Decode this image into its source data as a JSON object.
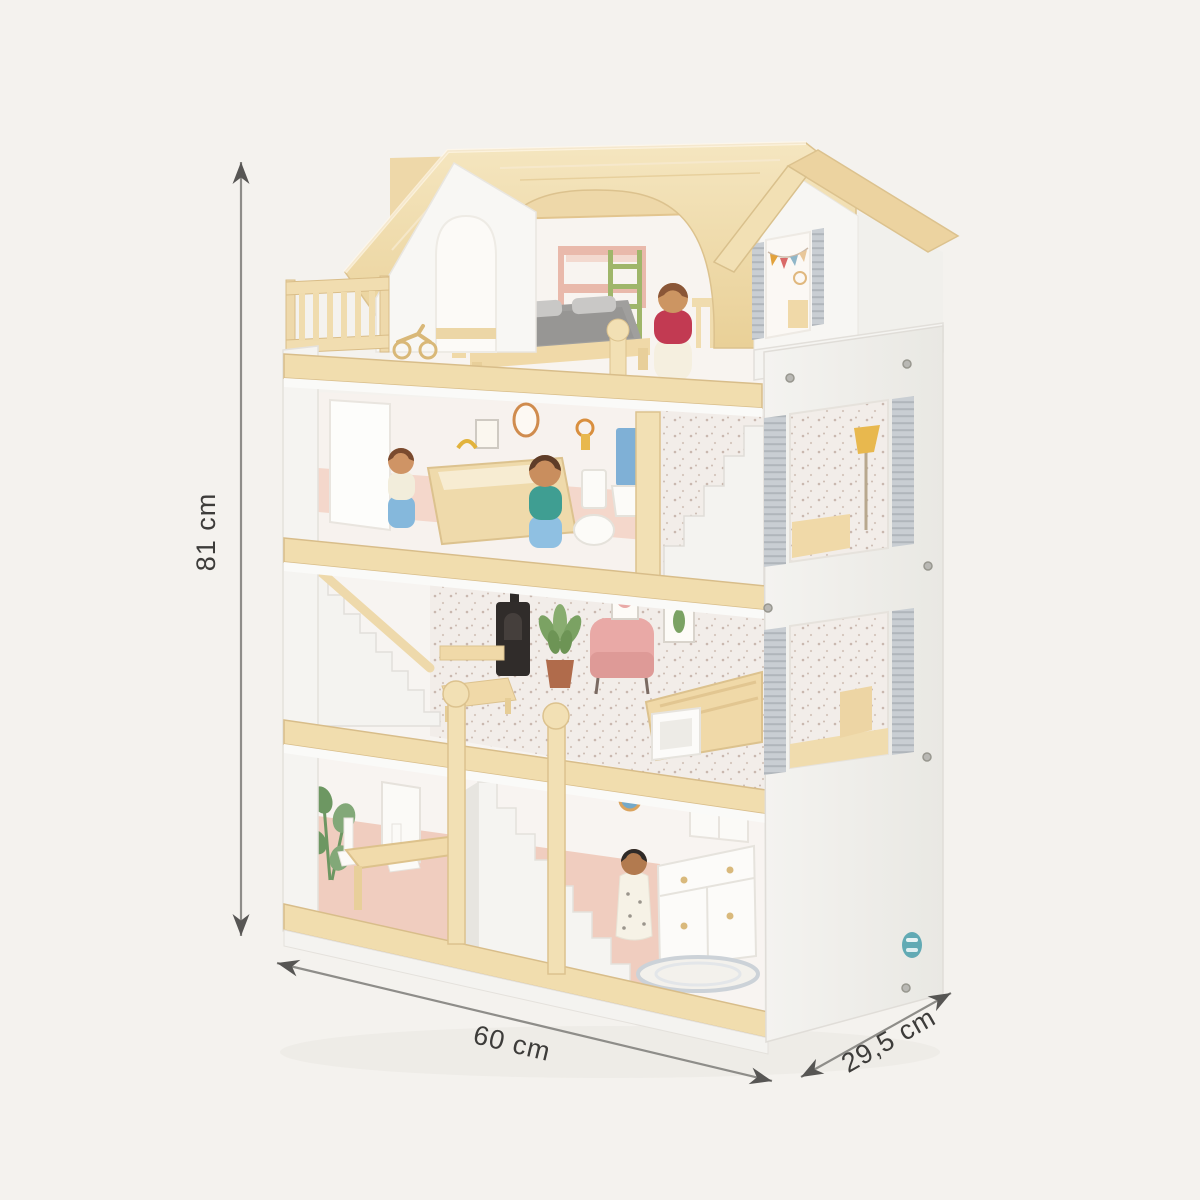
{
  "page": {
    "background_color": "#f4f2ee"
  },
  "dimension_annotation": {
    "height_label": "81 cm",
    "width_label": "60 cm",
    "depth_label": "29,5 cm",
    "line_color": "#8e8d89",
    "arrowhead_color": "#575654",
    "label_color": "#3d3c3a"
  },
  "product": {
    "name": "wooden dollhouse",
    "description": "Three-storey toy wooden dollhouse with natural pine roof and trims, white side panel with two shuttered window openings, front tower gable with bunting decal, balcony, white staircases, furniture decals and peg dolls",
    "colors": {
      "roof_wood": "#f0dcab",
      "wood_trim": "#f1ddae",
      "panel_white": "#f1f0ec",
      "interior_wall": "#f7f2ee",
      "wainscot_pink": "#efcabc",
      "wallpaper": "#f2ede9",
      "shutter_gray": "#c9ced3",
      "doll_red": "#c23a52",
      "doll_teal": "#3f9e92",
      "doll_blue": "#85b8dc",
      "bedding_gray": "#a09f9d",
      "logo_teal": "#62aab4"
    }
  }
}
